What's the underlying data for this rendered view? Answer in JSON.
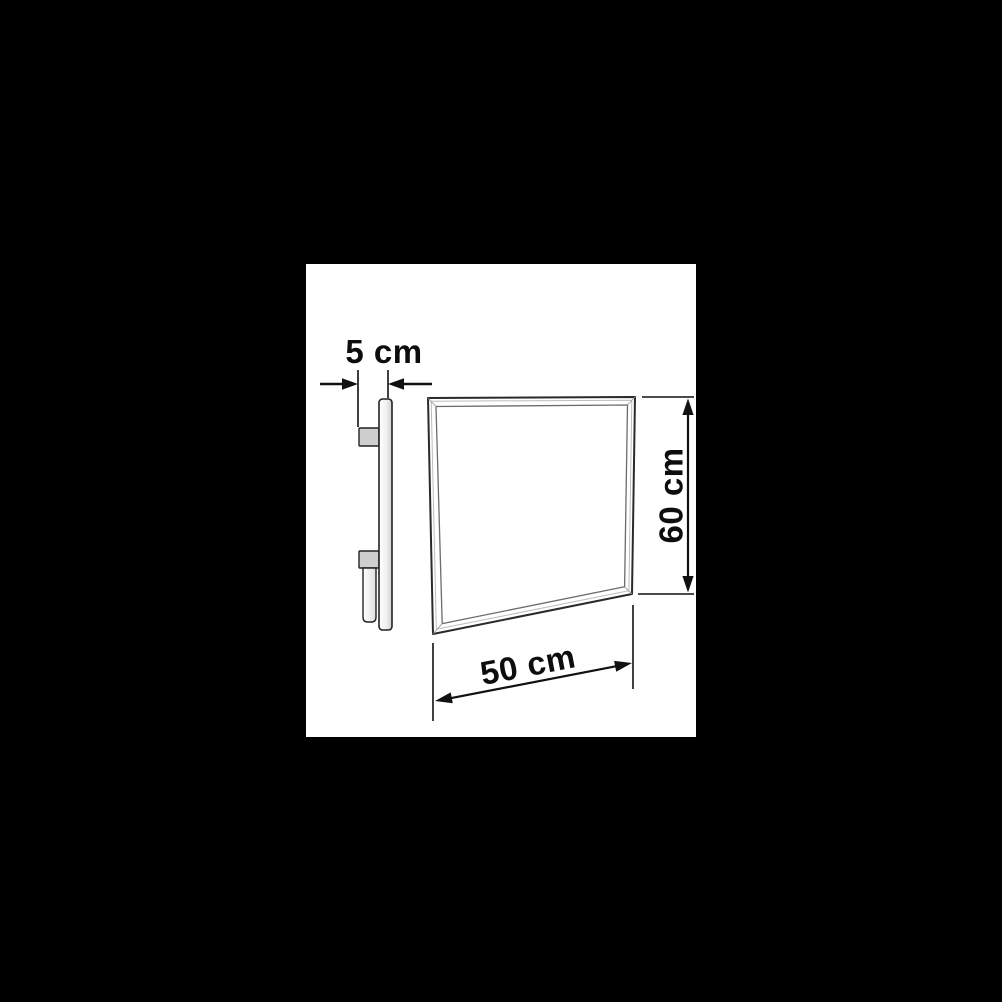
{
  "page": {
    "background_color": "#000000"
  },
  "canvas": {
    "background_color": "#ffffff"
  },
  "diagram": {
    "type": "technical-dimension-drawing",
    "line_color": "#222222",
    "dimension_line_color": "#111111",
    "text_color": "#0d0d0d",
    "bracket_fill": "#cfcfcf",
    "panel_fill": "#ffffff",
    "dimensions": {
      "depth": {
        "label": "5 cm",
        "value": "5",
        "unit": "cm"
      },
      "height": {
        "label": "60 cm",
        "value": "60",
        "unit": "cm"
      },
      "width": {
        "label": "50 cm",
        "value": "50",
        "unit": "cm"
      }
    }
  }
}
